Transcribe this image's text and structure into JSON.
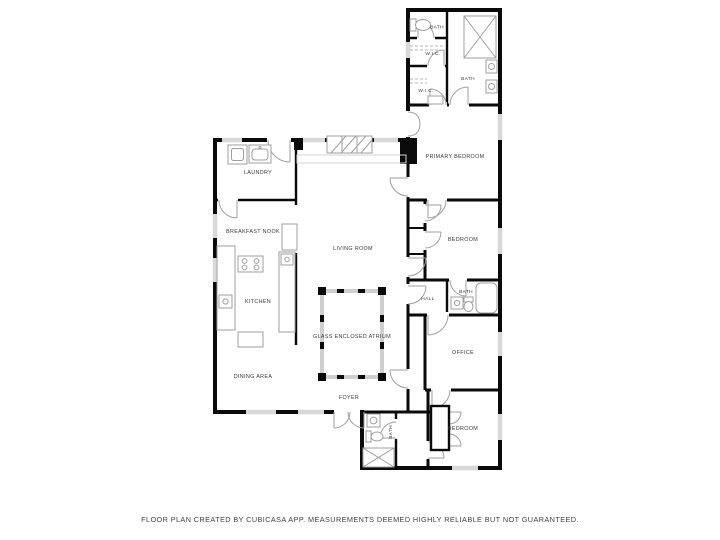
{
  "page": {
    "background": "#ffffff"
  },
  "colors": {
    "wall": "#0a0a0a",
    "window": "#d8d8d8",
    "door_fixture": "#9f9f9f",
    "glass_wall": "#cfcfcf",
    "label_text": "#3a3a3a"
  },
  "rooms": [
    {
      "id": "bath-top",
      "label": "BATH"
    },
    {
      "id": "wic-upper",
      "label": "W.I.C."
    },
    {
      "id": "wic-lower",
      "label": "W.I.C."
    },
    {
      "id": "primary-bath",
      "label": "BATH"
    },
    {
      "id": "primary-bedroom",
      "label": "PRIMARY BEDROOM"
    },
    {
      "id": "bedroom-middle",
      "label": "BEDROOM"
    },
    {
      "id": "hall",
      "label": "HALL"
    },
    {
      "id": "hall-bath",
      "label": "BATH"
    },
    {
      "id": "office",
      "label": "OFFICE"
    },
    {
      "id": "bedroom-bottom",
      "label": "BEDROOM"
    },
    {
      "id": "foyer-bath",
      "label": "BATH"
    },
    {
      "id": "laundry",
      "label": "LAUNDRY"
    },
    {
      "id": "breakfast-nook",
      "label": "BREAKFAST NOOK"
    },
    {
      "id": "kitchen",
      "label": "KITCHEN"
    },
    {
      "id": "dining-area",
      "label": "DINING AREA"
    },
    {
      "id": "living-room",
      "label": "LIVING ROOM"
    },
    {
      "id": "atrium",
      "label": "GLASS ENCLOSED ATRIUM"
    },
    {
      "id": "foyer",
      "label": "FOYER"
    }
  ],
  "footer": {
    "caption": "FLOOR PLAN CREATED BY CUBICASA APP. MEASUREMENTS DEEMED HIGHLY RELIABLE BUT NOT GUARANTEED."
  }
}
